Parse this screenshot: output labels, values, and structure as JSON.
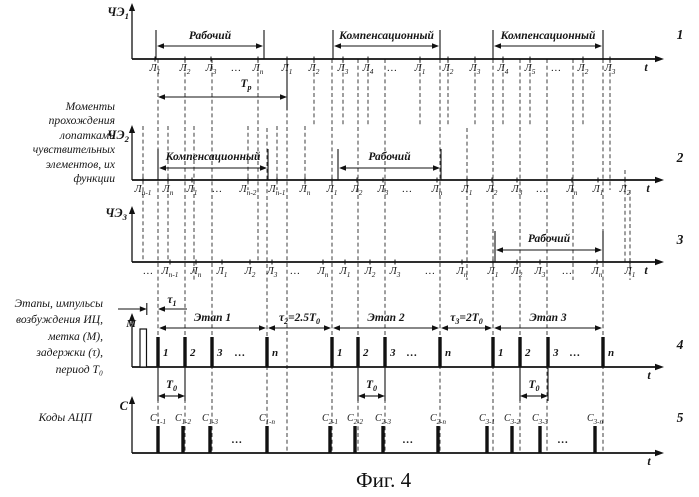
{
  "caption": "Фиг. 4",
  "left_labels": {
    "sensors": {
      "lines": [
        "Моменты",
        "прохождения",
        "лопатками",
        "чувствительных",
        "элементов, их",
        "функции"
      ]
    },
    "stages": {
      "lines": [
        "Этапы, импульсы",
        "возбуждения ИЦ,",
        "метка (М),",
        "задержки (τ),",
        "период Т₀"
      ]
    },
    "adc": {
      "text": "Коды АЦП"
    }
  },
  "diagram": {
    "width": 699,
    "height": 497,
    "axis_x": 132,
    "axis_end": 656,
    "ink": "#111111",
    "dashed": [
      {
        "x": 158,
        "y1": 59,
        "y2": 453
      },
      {
        "x": 185,
        "y1": 59,
        "y2": 453
      },
      {
        "x": 212,
        "y1": 59,
        "y2": 453
      },
      {
        "x": 287,
        "y1": 59,
        "y2": 453
      },
      {
        "x": 332,
        "y1": 59,
        "y2": 453
      },
      {
        "x": 358,
        "y1": 59,
        "y2": 453
      },
      {
        "x": 385,
        "y1": 59,
        "y2": 453
      },
      {
        "x": 440,
        "y1": 59,
        "y2": 453
      },
      {
        "x": 493,
        "y1": 59,
        "y2": 453
      },
      {
        "x": 520,
        "y1": 59,
        "y2": 453
      },
      {
        "x": 547,
        "y1": 59,
        "y2": 453
      },
      {
        "x": 603,
        "y1": 59,
        "y2": 453
      },
      {
        "x": 258,
        "y1": 59,
        "y2": 262
      },
      {
        "x": 267,
        "y1": 128,
        "y2": 453
      },
      {
        "x": 573,
        "y1": 59,
        "y2": 280
      },
      {
        "x": 314,
        "y1": 59,
        "y2": 126
      },
      {
        "x": 343,
        "y1": 59,
        "y2": 126
      },
      {
        "x": 368,
        "y1": 59,
        "y2": 126
      },
      {
        "x": 420,
        "y1": 59,
        "y2": 126
      },
      {
        "x": 448,
        "y1": 59,
        "y2": 126
      },
      {
        "x": 475,
        "y1": 59,
        "y2": 126
      },
      {
        "x": 503,
        "y1": 59,
        "y2": 126
      },
      {
        "x": 530,
        "y1": 59,
        "y2": 126
      },
      {
        "x": 583,
        "y1": 59,
        "y2": 126
      },
      {
        "x": 610,
        "y1": 59,
        "y2": 190
      },
      {
        "x": 143,
        "y1": 126,
        "y2": 262
      },
      {
        "x": 168,
        "y1": 126,
        "y2": 262
      },
      {
        "x": 194,
        "y1": 126,
        "y2": 280
      },
      {
        "x": 248,
        "y1": 126,
        "y2": 190
      },
      {
        "x": 277,
        "y1": 126,
        "y2": 190
      },
      {
        "x": 305,
        "y1": 126,
        "y2": 190
      },
      {
        "x": 467,
        "y1": 128,
        "y2": 280
      },
      {
        "x": 625,
        "y1": 170,
        "y2": 262
      },
      {
        "x": 630,
        "y1": 190,
        "y2": 280
      }
    ],
    "rows": [
      {
        "num": "1",
        "num_y": 39,
        "axis_label": "ЧЭ_1",
        "axis_label_x": 129,
        "axis_label_y": 16,
        "baseline": 59,
        "axis_top": 3,
        "t_x": 646,
        "span_label_y": 39,
        "span_arrow_y": 46,
        "span_bound_top": 30,
        "ticks": [
          {
            "x": 155,
            "l": "Л_1"
          },
          {
            "x": 185,
            "l": "Л_2"
          },
          {
            "x": 211,
            "l": "Л_3"
          },
          {
            "x": 236,
            "l": "…"
          },
          {
            "x": 258,
            "l": "Л_n"
          },
          {
            "x": 287,
            "l": "Л_1"
          },
          {
            "x": 314,
            "l": "Л_2"
          },
          {
            "x": 343,
            "l": "Л_3"
          },
          {
            "x": 368,
            "l": "Л_4"
          },
          {
            "x": 392,
            "l": "…"
          },
          {
            "x": 420,
            "l": "Л_1"
          },
          {
            "x": 448,
            "l": "Л_2"
          },
          {
            "x": 475,
            "l": "Л_3"
          },
          {
            "x": 503,
            "l": "Л_4"
          },
          {
            "x": 530,
            "l": "Л_5"
          },
          {
            "x": 556,
            "l": "…"
          },
          {
            "x": 583,
            "l": "Л_2"
          },
          {
            "x": 610,
            "l": "Л_3"
          }
        ],
        "spans": [
          {
            "x1": 156,
            "x2": 264,
            "l": "Рабочий",
            "bounds": true
          },
          {
            "x1": 333,
            "x2": 440,
            "l": "Компенсационный",
            "bounds": true
          },
          {
            "x1": 493,
            "x2": 603,
            "l": "Компенсационный",
            "bounds": true
          }
        ],
        "dims": [
          {
            "x1": 158,
            "x2": 287,
            "l": "Т_р",
            "lx": 246,
            "label_y": 87,
            "arrow_y": 97,
            "bound_x": 287,
            "bound_y2": 110
          }
        ]
      },
      {
        "num": "2",
        "num_y": 162,
        "axis_label": "ЧЭ_2",
        "axis_label_x": 129,
        "axis_label_y": 139,
        "baseline": 180,
        "axis_top": 125,
        "t_x": 648,
        "span_label_y": 160,
        "span_arrow_y": 168,
        "span_bound_top": 149,
        "ticks": [
          {
            "x": 143,
            "l": "Л_{n-1}"
          },
          {
            "x": 168,
            "l": "Л_n"
          },
          {
            "x": 192,
            "l": "Л_1"
          },
          {
            "x": 217,
            "l": "…"
          },
          {
            "x": 248,
            "l": "Л_{n-2}"
          },
          {
            "x": 277,
            "l": "Л_{n-1}"
          },
          {
            "x": 305,
            "l": "Л_n"
          },
          {
            "x": 332,
            "l": "Л_1"
          },
          {
            "x": 357,
            "l": "Л_2"
          },
          {
            "x": 383,
            "l": "Л_3"
          },
          {
            "x": 407,
            "l": "…"
          },
          {
            "x": 437,
            "l": "Л_n"
          },
          {
            "x": 467,
            "l": "Л_1"
          },
          {
            "x": 492,
            "l": "Л_2"
          },
          {
            "x": 517,
            "l": "Л_3"
          },
          {
            "x": 541,
            "l": "…"
          },
          {
            "x": 572,
            "l": "Л_n"
          },
          {
            "x": 598,
            "l": "Л_1"
          },
          {
            "x": 625,
            "l": "Л_2"
          }
        ],
        "spans": [
          {
            "x1": 158,
            "x2": 268,
            "l": "Компенсационный",
            "bounds": true
          },
          {
            "x1": 338,
            "x2": 441,
            "l": "Рабочий",
            "bounds": true
          }
        ]
      },
      {
        "num": "3",
        "num_y": 244,
        "axis_label": "ЧЭ_3",
        "axis_label_x": 127,
        "axis_label_y": 217,
        "baseline": 262,
        "axis_top": 206,
        "t_x": 646,
        "span_label_y": 242,
        "span_arrow_y": 250,
        "span_bound_top": 231,
        "ticks": [
          {
            "x": 148,
            "l": "…"
          },
          {
            "x": 170,
            "l": "Л_{n-1}"
          },
          {
            "x": 196,
            "l": "Л_n"
          },
          {
            "x": 222,
            "l": "Л_1"
          },
          {
            "x": 250,
            "l": "Л_2"
          },
          {
            "x": 272,
            "l": "Л_3"
          },
          {
            "x": 295,
            "l": "…"
          },
          {
            "x": 323,
            "l": "Л_n"
          },
          {
            "x": 345,
            "l": "Л_1"
          },
          {
            "x": 370,
            "l": "Л_2"
          },
          {
            "x": 395,
            "l": "Л_3"
          },
          {
            "x": 430,
            "l": "…"
          },
          {
            "x": 462,
            "l": "Л_n"
          },
          {
            "x": 493,
            "l": "Л_1"
          },
          {
            "x": 517,
            "l": "Л_2"
          },
          {
            "x": 540,
            "l": "Л_3"
          },
          {
            "x": 567,
            "l": "…"
          },
          {
            "x": 597,
            "l": "Л_n"
          },
          {
            "x": 630,
            "l": "Л_1"
          }
        ],
        "spans": [
          {
            "x1": 495,
            "x2": 603,
            "l": "Рабочий",
            "bounds": true
          }
        ]
      },
      {
        "num": "4",
        "num_y": 349,
        "baseline": 367,
        "axis_top": 313,
        "t_x": 649,
        "span_label_y": 321,
        "span_arrow_y": 328,
        "bar_h": 30,
        "pulse_label": "right",
        "pulses": [
          {
            "x": 158,
            "l": "1"
          },
          {
            "x": 185,
            "l": "2"
          },
          {
            "x": 212,
            "l": "3"
          },
          {
            "x": 240,
            "l": "…"
          },
          {
            "x": 267,
            "l": "n"
          },
          {
            "x": 332,
            "l": "1"
          },
          {
            "x": 358,
            "l": "2"
          },
          {
            "x": 385,
            "l": "3"
          },
          {
            "x": 412,
            "l": "…"
          },
          {
            "x": 440,
            "l": "n"
          },
          {
            "x": 493,
            "l": "1"
          },
          {
            "x": 520,
            "l": "2"
          },
          {
            "x": 548,
            "l": "3"
          },
          {
            "x": 575,
            "l": "…"
          },
          {
            "x": 603,
            "l": "n"
          }
        ],
        "spans": [
          {
            "x1": 158,
            "x2": 267,
            "l": "Этап 1"
          },
          {
            "x1": 267,
            "x2": 332,
            "l": "τ_2=2.5Т_0"
          },
          {
            "x1": 332,
            "x2": 440,
            "l": "Этап 2"
          },
          {
            "x1": 440,
            "x2": 493,
            "l": "τ_3=2Т_0"
          },
          {
            "x1": 493,
            "x2": 603,
            "l": "Этап 3"
          }
        ],
        "dims": [
          {
            "x1": 158,
            "x2": 185,
            "l": "Т_0",
            "label_y": 388,
            "arrow_y": 396,
            "end_bounds": true
          },
          {
            "x1": 358,
            "x2": 385,
            "l": "Т_0",
            "label_y": 388,
            "arrow_y": 396,
            "end_bounds": true
          },
          {
            "x1": 520,
            "x2": 548,
            "l": "Т_0",
            "label_y": 388,
            "arrow_y": 396,
            "end_bounds": true
          }
        ],
        "mark": {
          "x": 140,
          "w": 6.5,
          "top": 329,
          "label": "М",
          "lx": 136,
          "ly": 327
        },
        "tau": {
          "label": "τ_1",
          "lx": 172,
          "ly": 303,
          "y": 309,
          "stop_x": 146.8,
          "gap_r": 158,
          "out_l": 118,
          "out_r": 187
        }
      },
      {
        "num": "5",
        "num_y": 422,
        "axis_label": "С",
        "axis_label_x": 128,
        "axis_label_y": 410,
        "baseline": 453,
        "axis_top": 396,
        "t_x": 649,
        "bar_h": 27,
        "pulse_label": "above",
        "pulses": [
          {
            "x": 158,
            "l": "С_{1-1}"
          },
          {
            "x": 183,
            "l": "С_{1-2}"
          },
          {
            "x": 210,
            "l": "С_{1-3}"
          },
          {
            "x": 237,
            "l": "…"
          },
          {
            "x": 267,
            "l": "С_{1-n}"
          },
          {
            "x": 330,
            "l": "С_{2-1}"
          },
          {
            "x": 355,
            "l": "С_{2-2}"
          },
          {
            "x": 383,
            "l": "С_{2-3}"
          },
          {
            "x": 408,
            "l": "…"
          },
          {
            "x": 438,
            "l": "С_{2-n}"
          },
          {
            "x": 487,
            "l": "С_{3-1}"
          },
          {
            "x": 512,
            "l": "С_{3-2}"
          },
          {
            "x": 540,
            "l": "С_{3-3}"
          },
          {
            "x": 563,
            "l": "…"
          },
          {
            "x": 595,
            "l": "С_{3-n}"
          }
        ]
      }
    ]
  }
}
